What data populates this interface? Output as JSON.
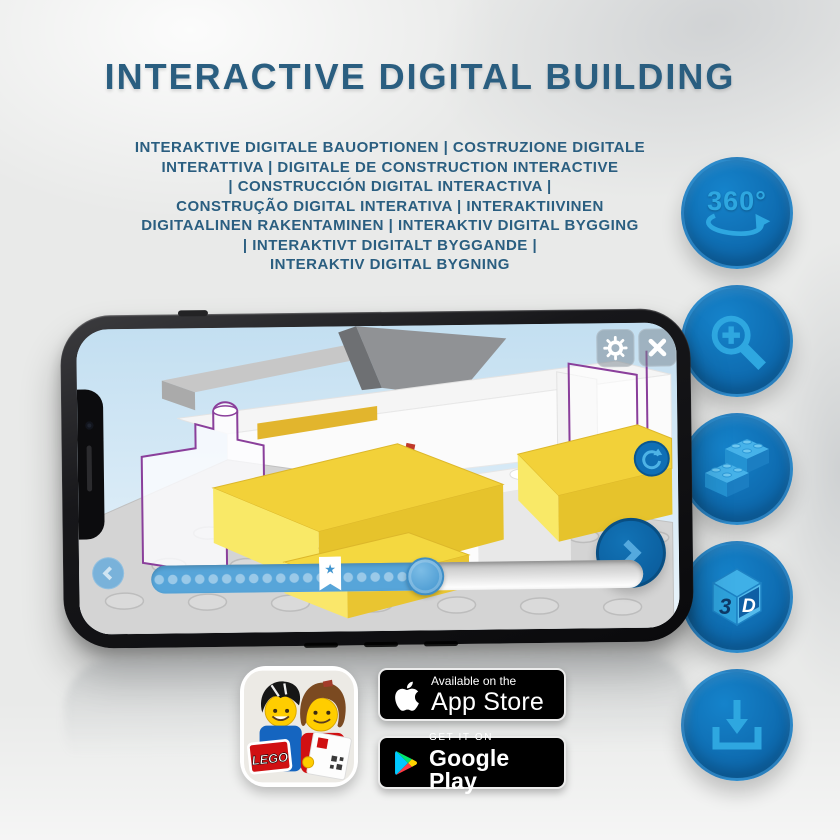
{
  "header": {
    "title": "INTERACTIVE DIGITAL BUILDING"
  },
  "subtitle": {
    "lines": [
      "INTERAKTIVE DIGITALE BAUOPTIONEN | COSTRUZIONE DIGITALE",
      "INTERATTIVA | DIGITALE DE CONSTRUCTION INTERACTIVE",
      "| CONSTRUCCIÓN DIGITAL INTERACTIVA |",
      "CONSTRUÇÃO DIGITAL INTERATIVA | INTERAKTIIVINEN",
      "DIGITAALINEN RAKENTAMINEN | INTERAKTIV DIGITAL BYGGING",
      "| INTERAKTIVT DIGITALT BYGGANDE |",
      "INTERAKTIV DIGITAL BYGNING"
    ]
  },
  "features": {
    "items": [
      {
        "icon": "360-rotation-icon",
        "label": "360°"
      },
      {
        "icon": "zoom-in-icon"
      },
      {
        "icon": "lego-bricks-icon"
      },
      {
        "icon": "3d-cube-icon",
        "left_face": "3",
        "right_face": "D"
      },
      {
        "icon": "download-icon"
      }
    ]
  },
  "phone": {
    "screen_controls": {
      "settings_icon": "gear",
      "close_icon": "x-cross",
      "rotate_icon": "circular-arrow",
      "next_icon": "chevron-right",
      "previous_icon": "chevron-left",
      "slider": {
        "progress_percent": 56,
        "bookmark_star": "★"
      }
    }
  },
  "store": {
    "app_icon_label": "LEGO",
    "app_store": {
      "tagline": "Available on the",
      "name": "App Store"
    },
    "google_play": {
      "tagline": "GET IT ON",
      "name": "Google Play"
    }
  },
  "colors": {
    "title_blue": "#2a5e80",
    "circle_blue": "#0d67ab",
    "glyph_blue": "#2ea7e0",
    "brick_yellow": "#f2d139",
    "slider_blue": "#57a5d9",
    "outline_purple": "#8a3f9b"
  }
}
